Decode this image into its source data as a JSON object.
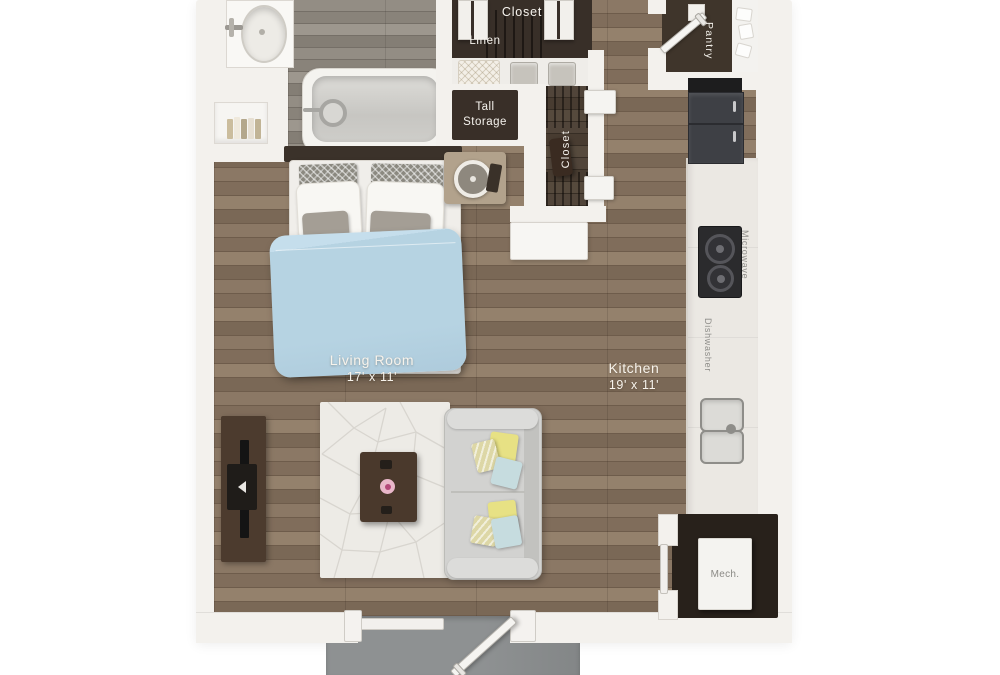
{
  "plan": {
    "rooms": {
      "living_room": {
        "name": "Living Room",
        "dims": "17' x 11'"
      },
      "kitchen": {
        "name": "Kitchen",
        "dims": "19' x 11'"
      },
      "closet_top": {
        "name": "Closet"
      },
      "linen": {
        "name": "Linen"
      },
      "tall_storage": {
        "name": "Tall Storage"
      },
      "closet_side": {
        "name": "Closet"
      },
      "pantry": {
        "name": "Pantry"
      },
      "mech": {
        "name": "Mech."
      }
    },
    "appliances": {
      "microwave": "Microwave",
      "dishwasher": "Dishwasher"
    },
    "colors": {
      "wall": "#f3f1ed",
      "floor_wood": "#83705d",
      "floor_bath": "#8a847b",
      "closet_dark": "#382f28",
      "mech_room": "#28211b",
      "duvet_blue": "#b6d3e2",
      "sofa_gray": "#d2d2d0",
      "pillow_yellow": "#e7e184",
      "pillow_ice_blue": "#c6dcdf",
      "patio_concrete": "#8e9192"
    }
  }
}
